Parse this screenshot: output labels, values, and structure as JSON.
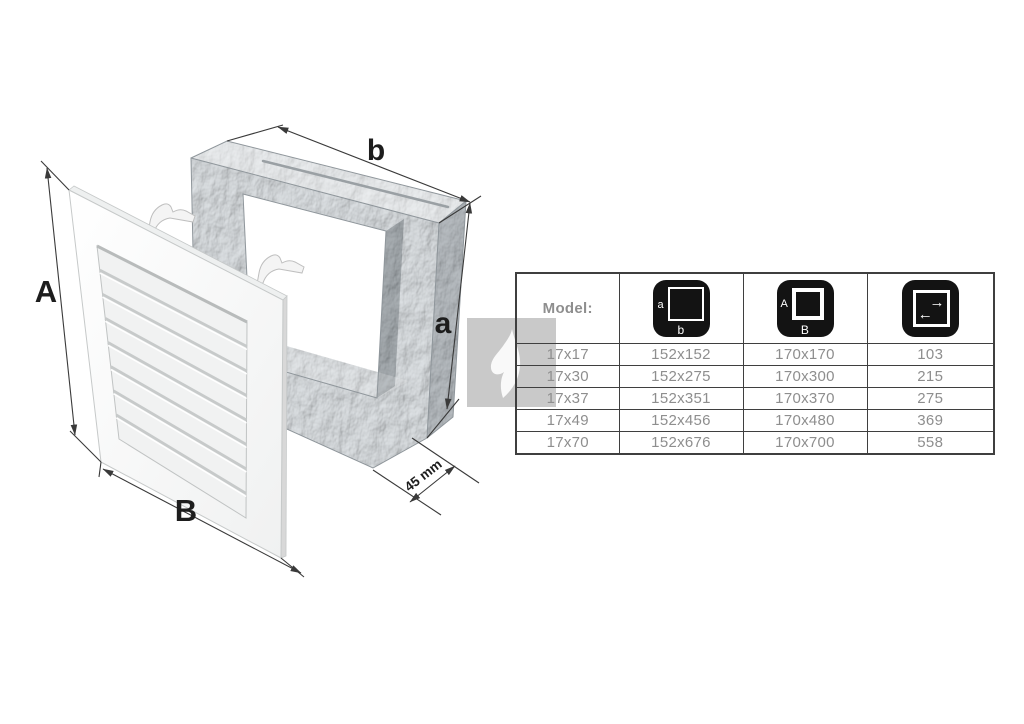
{
  "diagram": {
    "labels": {
      "front_height": "A",
      "front_width": "B",
      "duct_width": "b",
      "duct_height": "a",
      "duct_depth": "45 mm"
    }
  },
  "watermark": {
    "icon": "flame"
  },
  "table": {
    "model_label": "Model:",
    "header_icons": [
      {
        "name": "inner-dimension-icon",
        "side_label": "a",
        "bottom_label": "b"
      },
      {
        "name": "outer-dimension-icon",
        "side_label": "A",
        "bottom_label": "B"
      },
      {
        "name": "airflow-icon",
        "arrow_right": "→",
        "arrow_left": "←"
      }
    ],
    "rows": [
      [
        "17x17",
        "152x152",
        "170x170",
        "103"
      ],
      [
        "17x30",
        "152x275",
        "170x300",
        "215"
      ],
      [
        "17x37",
        "152x351",
        "170x370",
        "275"
      ],
      [
        "17x49",
        "152x456",
        "170x480",
        "369"
      ],
      [
        "17x70",
        "152x676",
        "170x700",
        "558"
      ]
    ]
  },
  "colors": {
    "table_border": "#3f3f3f",
    "data_text": "#8e8e8e",
    "header_text": "#2f2f2f",
    "icon_bg": "#131313",
    "watermark_gray": "#c9c9c9",
    "dimension_line": "#3a3a3a",
    "galvanized_base": "#b6bcc1"
  }
}
